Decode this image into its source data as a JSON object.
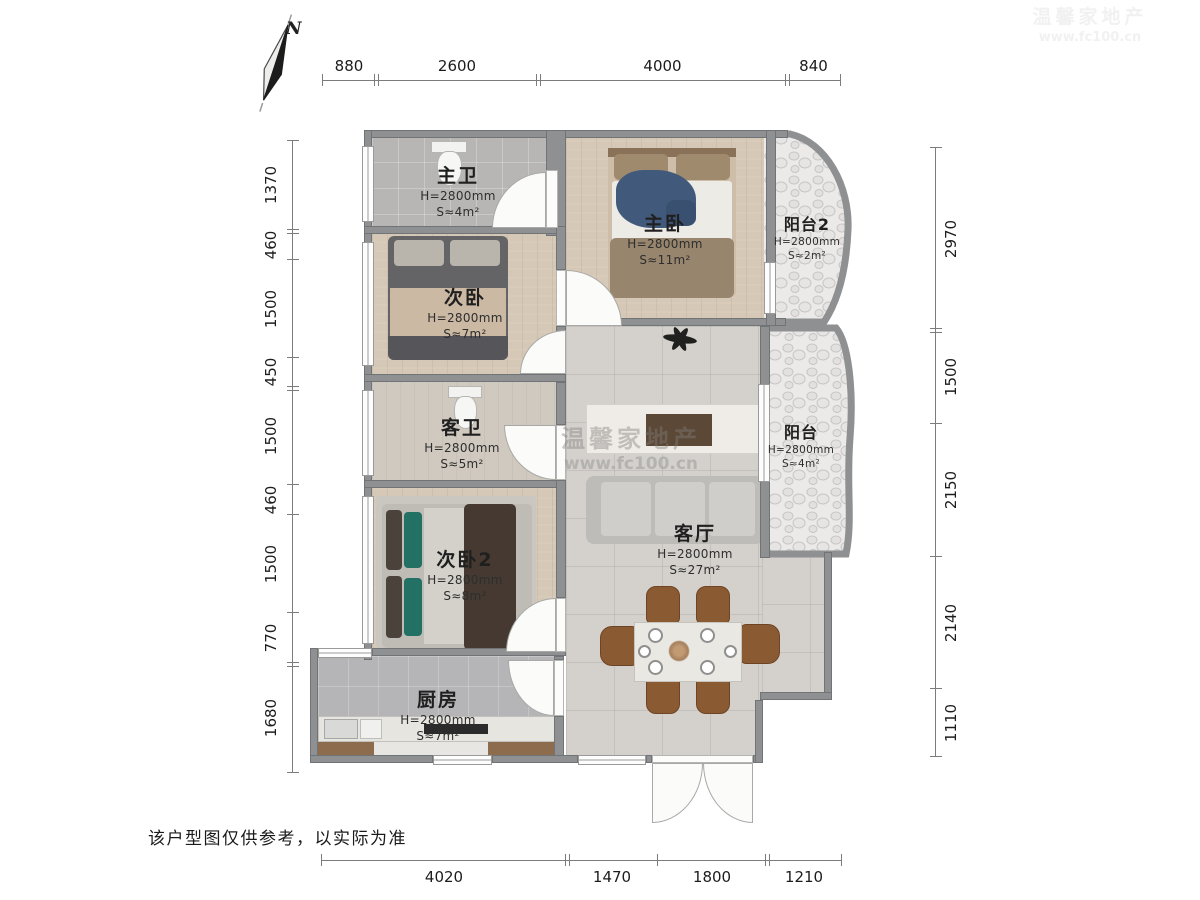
{
  "compass": {
    "label": "N"
  },
  "disclaimer": "该户型图仅供参考，以实际为准",
  "watermark": {
    "line1": "温馨家地产",
    "line2": "www.fc100.cn"
  },
  "rooms": [
    {
      "id": "master-bath",
      "name": "主卫",
      "height": "H=2800mm",
      "area": "S≈4m²"
    },
    {
      "id": "master-bedroom",
      "name": "主卧",
      "height": "H=2800mm",
      "area": "S≈11m²"
    },
    {
      "id": "balcony-2",
      "name": "阳台2",
      "height": "H=2800mm",
      "area": "S≈2m²"
    },
    {
      "id": "bedroom-2",
      "name": "次卧",
      "height": "H=2800mm",
      "area": "S≈7m²"
    },
    {
      "id": "guest-bath",
      "name": "客卫",
      "height": "H=2800mm",
      "area": "S≈5m²"
    },
    {
      "id": "balcony",
      "name": "阳台",
      "height": "H=2800mm",
      "area": "S≈4m²"
    },
    {
      "id": "living-room",
      "name": "客厅",
      "height": "H=2800mm",
      "area": "S≈27m²"
    },
    {
      "id": "bedroom-3",
      "name": "次卧2",
      "height": "H=2800mm",
      "area": "S≈8m²"
    },
    {
      "id": "kitchen",
      "name": "厨房",
      "height": "H=2800mm",
      "area": "S≈7m²"
    }
  ],
  "dimensions": {
    "top": [
      "880",
      "2600",
      "4000",
      "840"
    ],
    "left": [
      "1370",
      "460",
      "1500",
      "450",
      "1500",
      "460",
      "1500",
      "770",
      "1680"
    ],
    "right": [
      "2970",
      "1500",
      "2150",
      "2140",
      "1110"
    ],
    "bottom": [
      "4020",
      "1470",
      "1800",
      "1210"
    ]
  }
}
